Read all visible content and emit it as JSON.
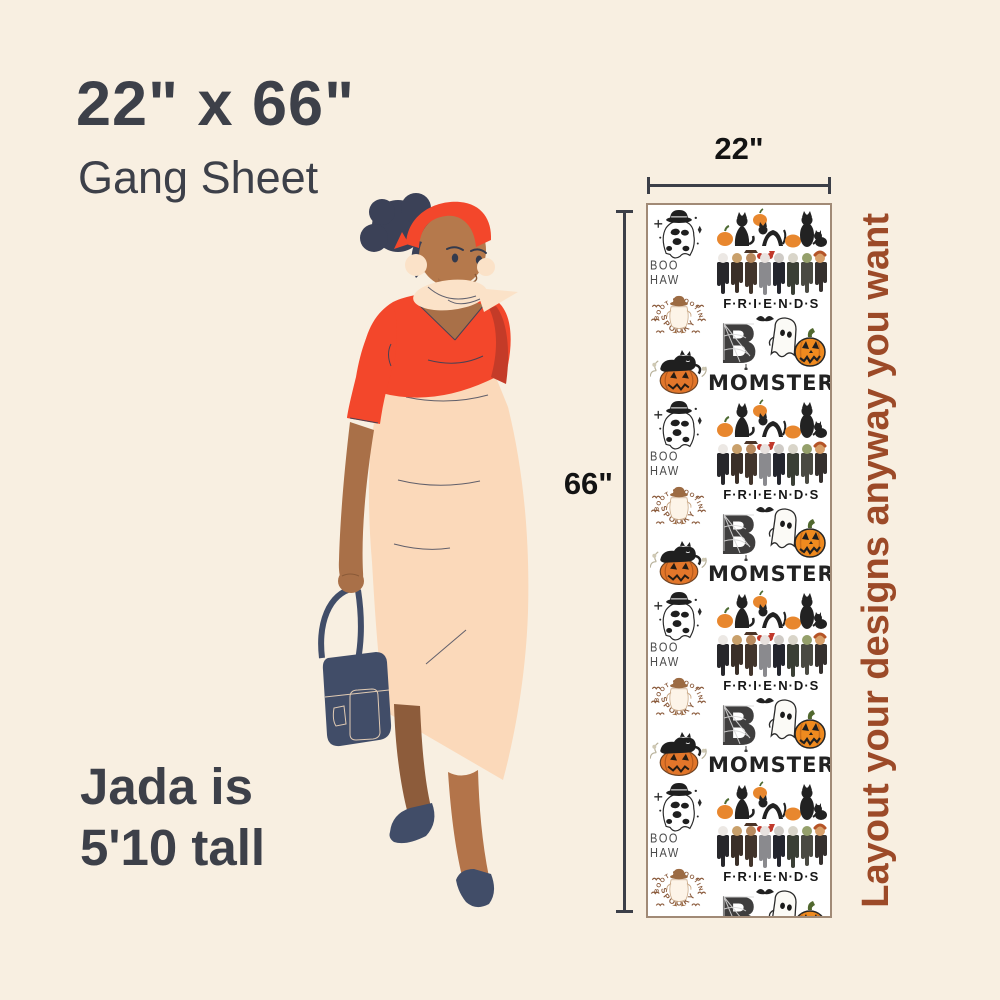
{
  "page": {
    "background": "#f8efe1"
  },
  "header": {
    "title": "22\" x 66\"",
    "subtitle": "Gang Sheet"
  },
  "measurements": {
    "width_label": "22\"",
    "height_label": "66\""
  },
  "model": {
    "note_line1": "Jada is",
    "note_line2": "5'10 tall"
  },
  "side_note": {
    "text": "Layout your designs anyway you want",
    "color": "#9c4a28"
  },
  "sheet": {
    "repeat_count": 4,
    "background": "#ffffff",
    "border_color": "#a18a76",
    "designs": {
      "boo_haw": {
        "label": "BOO HAW"
      },
      "boot_scootin": {
        "arc_top": "BOOT SCOOTIN'",
        "arc_bottom": "SPOOKY"
      },
      "friends": {
        "label": "F·R·I·E·N·D·S"
      },
      "boo": {
        "letter": "B"
      },
      "momster": {
        "label": "MOMSTER"
      }
    }
  },
  "palette": {
    "accent_red": "#f3472b",
    "dark_red_shade": "#c43b28",
    "skirt_peach": "#fbd9ba",
    "skin": "#b5794c",
    "navy": "#414d68",
    "hair_navy": "#3b4157",
    "pumpkin_orange": "#ef8a1f",
    "badge_brown": "#8a5a3b",
    "text_dark": "#3d4049",
    "measure_line": "#3c3f48"
  }
}
